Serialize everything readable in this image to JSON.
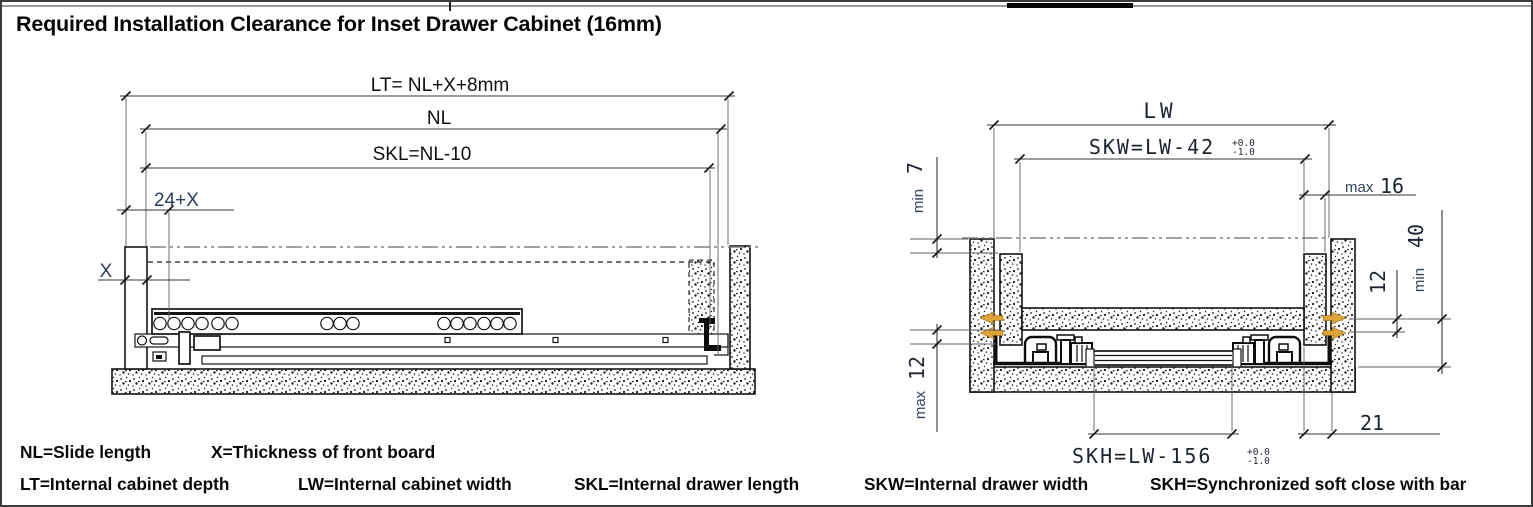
{
  "title": "Required Installation Clearance for Inset Drawer Cabinet (16mm)",
  "side_view": {
    "lt": "LT= NL+X+8mm",
    "nl": "NL",
    "skl": "SKL=NL-10",
    "front_offset": "24+X",
    "front_thickness": "X"
  },
  "front_view": {
    "lw": "LW",
    "skw": "SKW=LW-42",
    "skw_tol_plus": "+0.0",
    "skw_tol_minus": "-1.0",
    "skh": "SKH=LW-156",
    "skh_tol_plus": "+0.0",
    "skh_tol_minus": "-1.0",
    "min7_word": "min",
    "min7_value": "7",
    "max16_word": "max",
    "max16_value": "16",
    "gap12": "12",
    "min40_word": "min",
    "min40_value": "40",
    "max12_word": "max",
    "max12_value": "12",
    "bottom21": "21"
  },
  "legend": {
    "row1": [
      "NL=Slide length",
      "X=Thickness of front board"
    ],
    "row2": [
      "LT=Internal cabinet depth",
      "LW=Internal cabinet width",
      "SKL=Internal drawer length",
      "SKW=Internal drawer width",
      "SKH=Synchronized soft close with bar"
    ]
  },
  "colors": {
    "fitting_orange": "#DFA437",
    "dimension_navy": "#2c3c5c",
    "line_black": "#141414"
  }
}
